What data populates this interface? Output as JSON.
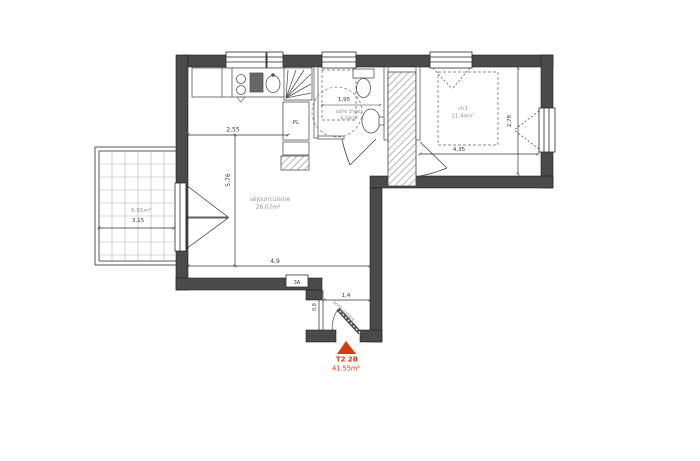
{
  "meta": {
    "type_label": "T2 2B",
    "total_area": "41.55m²"
  },
  "rooms": {
    "sejour": {
      "name": "séjour/cuisine",
      "area": "26.07m²"
    },
    "salle_eau": {
      "name": "salle d'eau",
      "area": "4.04m²"
    },
    "chambre": {
      "name": "ch1",
      "area": "11.44m²"
    },
    "balcon": {
      "area": "6.91m²"
    }
  },
  "labels": {
    "closet": "PL",
    "panel": "3A",
    "entry_door": "porte palière"
  },
  "dims": {
    "kitchen_w": "2,55",
    "sejour_h": "5,76",
    "sejour_w": "4,9",
    "sde_w": "1,95",
    "ch_w": "4,35",
    "ch_h": "2,78",
    "entry_w": "1,4",
    "entry_h": "0,9",
    "balcon_w": "3,15"
  },
  "colors": {
    "accent": "#d63b10",
    "wall": "#4a4a4a",
    "room_label": "#949494"
  }
}
